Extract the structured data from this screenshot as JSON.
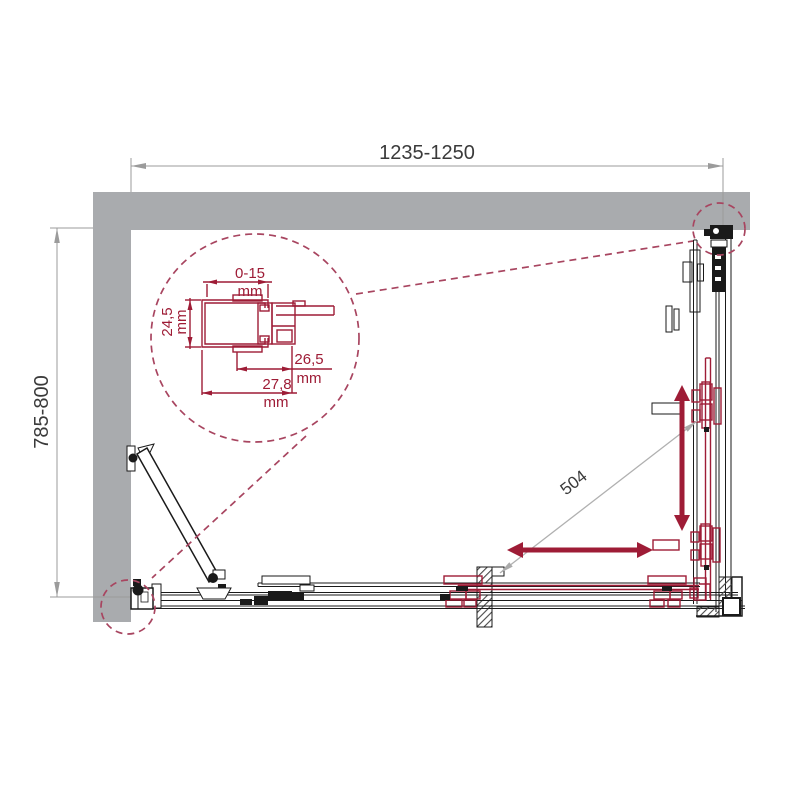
{
  "diagram": {
    "type": "technical-installation-drawing",
    "subject": "corner shower enclosure, top view with magnified wall-profile detail",
    "colors": {
      "wall_gray": "#A9ABAE",
      "line_black": "#1A1A1A",
      "dimension_gray": "#9B9B9B",
      "dimension_text": "#3A3A3A",
      "accent_maroon": "#9E1C36",
      "callout_dashed": "#A84560"
    }
  },
  "labels": {
    "width": "1235-1250",
    "depth": "785-800",
    "diagonal": "504",
    "detail_adjustment": "0-15",
    "detail_adjustment_unit": "mm",
    "detail_height": "24,5",
    "detail_height_unit": "mm",
    "detail_width_inner": "26,5",
    "detail_width_inner_unit": "mm",
    "detail_width_outer": "27,8",
    "detail_width_outer_unit": "mm"
  }
}
